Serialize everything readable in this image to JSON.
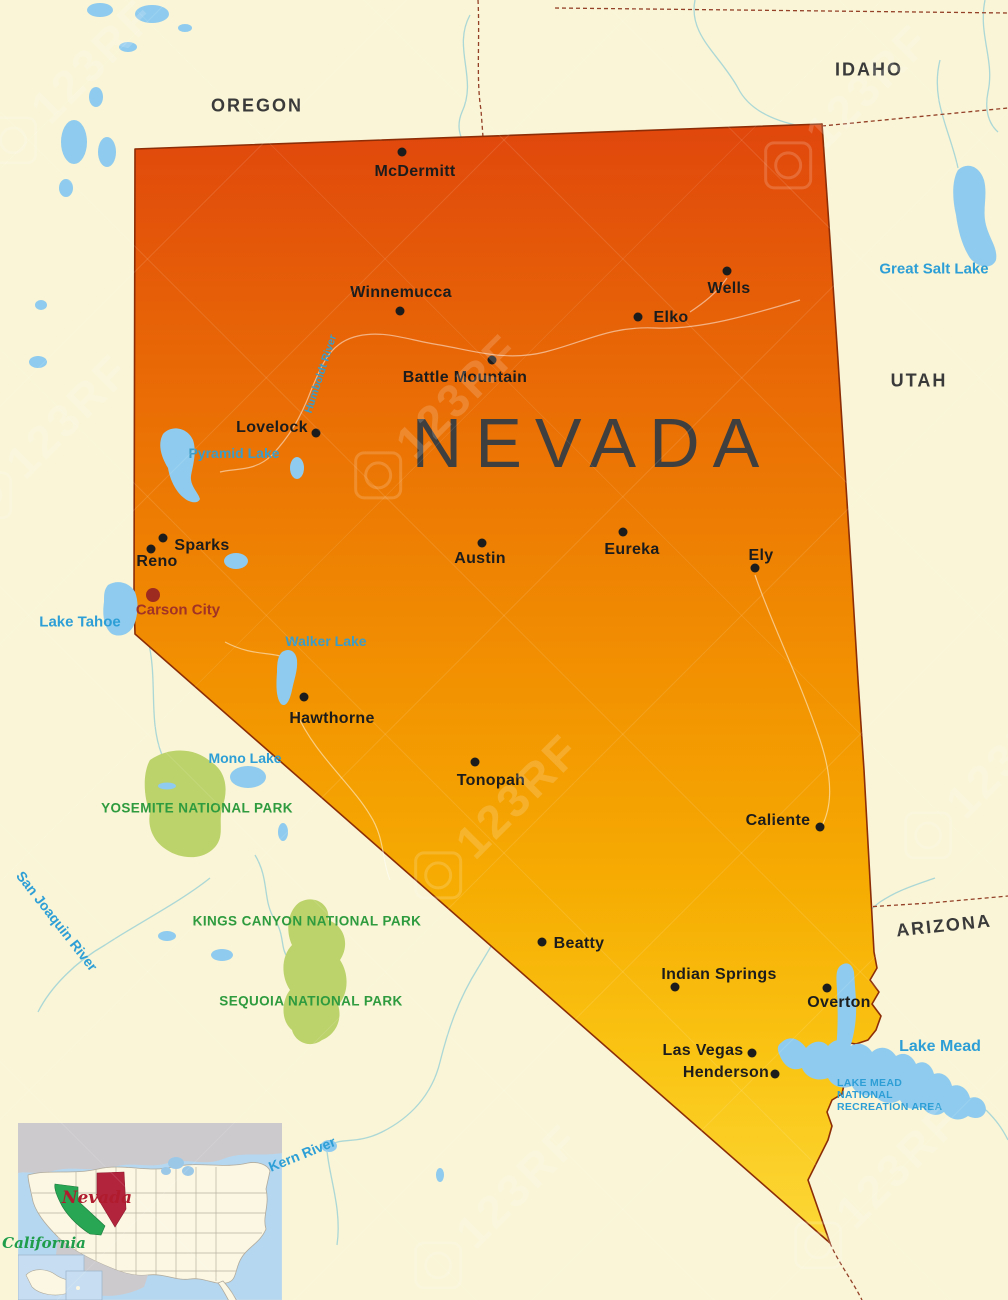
{
  "title": "NEVADA",
  "colors": {
    "background": "#F9F5D6",
    "nevada_gradient_top": "#E0470C",
    "nevada_gradient_mid": "#F29201",
    "nevada_gradient_bottom": "#FCD838",
    "state_border_line": "#8C2D07",
    "dashed_border": "#944028",
    "lake_fill": "#8FCBEE",
    "lake_label": "#2E9FD6",
    "park_fill": "#BCD26A",
    "park_label": "#2E9B3F",
    "city_dot": "#1C1C1C",
    "capital_color": "#9E2B1F",
    "inset_nevada": "#B2243C",
    "inset_california": "#28A653"
  },
  "states": {
    "oregon": "OREGON",
    "idaho": "IDAHO",
    "utah": "UTAH",
    "arizona": "ARIZONA",
    "nevada_title": "NEVADA"
  },
  "cities": {
    "mcdermitt": "McDermitt",
    "winnemucca": "Winnemucca",
    "wells": "Wells",
    "elko": "Elko",
    "battle_mountain": "Battle Mountain",
    "lovelock": "Lovelock",
    "sparks": "Sparks",
    "reno": "Reno",
    "carson_city": "Carson City",
    "austin": "Austin",
    "eureka": "Eureka",
    "ely": "Ely",
    "hawthorne": "Hawthorne",
    "tonopah": "Tonopah",
    "caliente": "Caliente",
    "beatty": "Beatty",
    "indian_springs": "Indian Springs",
    "overton": "Overton",
    "las_vegas": "Las Vegas",
    "henderson": "Henderson"
  },
  "water": {
    "lake_tahoe": "Lake Tahoe",
    "pyramid_lake": "Pyramid Lake",
    "walker_lake": "Walker Lake",
    "mono_lake": "Mono Lake",
    "great_salt_lake": "Great Salt Lake",
    "lake_mead": "Lake Mead",
    "humboldt_river": "Humboldt River",
    "san_joaquin_river": "San Joaquin River",
    "kern_river": "Kern River",
    "lake_mead_nra": {
      "line1": "LAKE MEAD",
      "line2": "NATIONAL",
      "line3": "RECREATION AREA"
    }
  },
  "parks": {
    "yosemite": "YOSEMITE NATIONAL PARK",
    "kings_canyon": "KINGS CANYON NATIONAL PARK",
    "sequoia": "SEQUOIA NATIONAL PARK"
  },
  "inset": {
    "nevada_label": "Nevada",
    "california_label": "California"
  },
  "watermark": {
    "text": "123RF"
  }
}
